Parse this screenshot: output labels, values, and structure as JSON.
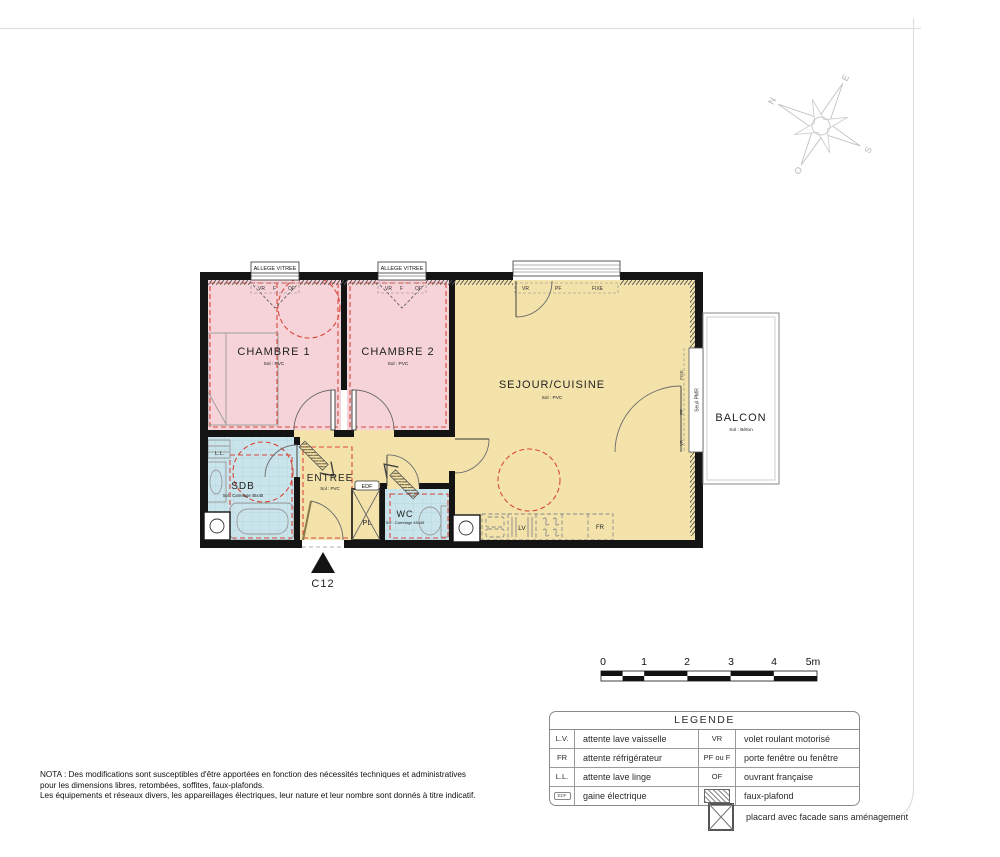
{
  "compass": {
    "n": "N",
    "e": "E",
    "s": "S",
    "o": "O"
  },
  "plan": {
    "unit_label": "C12",
    "rooms": {
      "chambre1": {
        "name": "CHAMBRE 1",
        "floor": "Sol : PVC"
      },
      "chambre2": {
        "name": "CHAMBRE 2",
        "floor": "Sol : PVC"
      },
      "sejour": {
        "name": "SEJOUR/CUISINE",
        "floor": "Sol : PVC"
      },
      "entree": {
        "name": "ENTREE",
        "floor": "Sol : PVC"
      },
      "sdb": {
        "name": "SDB",
        "floor": "Sol : Carrelage 45x45"
      },
      "wc": {
        "name": "WC",
        "floor": "Sol : Carrelage 45x45"
      },
      "pl": {
        "name": "PL"
      },
      "balcon": {
        "name": "BALCON",
        "floor": "Sol : Béton"
      }
    },
    "labels": {
      "allege_vitree": "ALLEGE VITREE",
      "vr": "VR",
      "f": "F",
      "of": "OF",
      "pf": "PF",
      "fixe": "FIXE",
      "seuil_pmr": "Seuil PMR",
      "ll": "L.L.",
      "lv": "LV",
      "fr": "FR",
      "edf": "EDF"
    },
    "colors": {
      "bedroom": "#f5d3d9",
      "living": "#f3e3ab",
      "wet": "#c9e4eb",
      "wall": "#141414",
      "accent_dashed": "#d9483b"
    }
  },
  "scalebar": {
    "ticks": [
      "0",
      "1",
      "2",
      "3",
      "4",
      "5m"
    ]
  },
  "legend": {
    "title": "LEGENDE",
    "rows": [
      {
        "sym1": "L.V.",
        "label1": "attente lave vaisselle",
        "sym2": "VR",
        "label2": "volet roulant motorisé"
      },
      {
        "sym1": "FR",
        "label1": "attente réfrigérateur",
        "sym2": "PF ou F",
        "label2": "porte fenêtre ou fenêtre"
      },
      {
        "sym1": "L.L.",
        "label1": "attente lave linge",
        "sym2": "OF",
        "label2": "ouvrant française"
      },
      {
        "sym1": "EDF",
        "label1": "gaine électrique",
        "sym2": "",
        "label2": "faux-plafond"
      }
    ],
    "placard_note": "placard avec facade sans aménagement"
  },
  "nota": {
    "lines": [
      "NOTA : Des modifications sont susceptibles d'être apportées en fonction des nécessités techniques et administratives",
      "pour les dimensions libres, retombées, soffites, faux-plafonds.",
      "Les équipements et réseaux divers, les appareillages électriques, leur nature et leur nombre sont donnés à titre indicatif."
    ]
  }
}
